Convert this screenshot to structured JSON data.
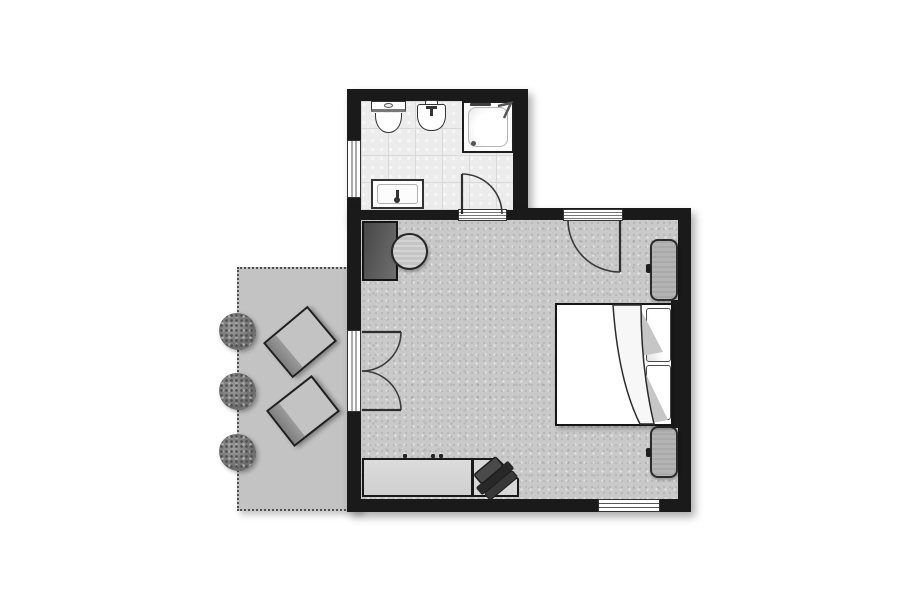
{
  "meta": {
    "title": "hotel-room-floor-plan",
    "canvas": {
      "width": 913,
      "height": 608
    }
  },
  "colors": {
    "wall": "#1a1a1a",
    "bath_floor": "#ececec",
    "tile_line": "#d9d9d9",
    "carpet": "#c9c9c9",
    "terrace": "#c3c3c3",
    "table": "#c5c5c5",
    "nightstand": "#b4b4b4",
    "lounger_back": "#7f7f7f"
  },
  "rooms": {
    "bathroom": {
      "name": "bathroom",
      "fixtures": [
        "toilet",
        "bidet",
        "shower",
        "vanity-sink"
      ],
      "openings": [
        "window-left-wall",
        "door-to-bedroom"
      ]
    },
    "bedroom": {
      "name": "bedroom",
      "furniture": [
        "cabinet",
        "round-table",
        "double-bed",
        "pillow",
        "pillow",
        "headboard",
        "nightstand-upper",
        "nightstand-lower",
        "desk",
        "desk-angled-return",
        "office-chair"
      ],
      "openings": [
        "entry-door-top-wall",
        "french-doors-to-terrace",
        "window-bottom-wall"
      ]
    },
    "terrace": {
      "name": "terrace",
      "furniture": [
        "sun-lounger",
        "sun-lounger",
        "bush",
        "bush",
        "bush"
      ]
    }
  }
}
